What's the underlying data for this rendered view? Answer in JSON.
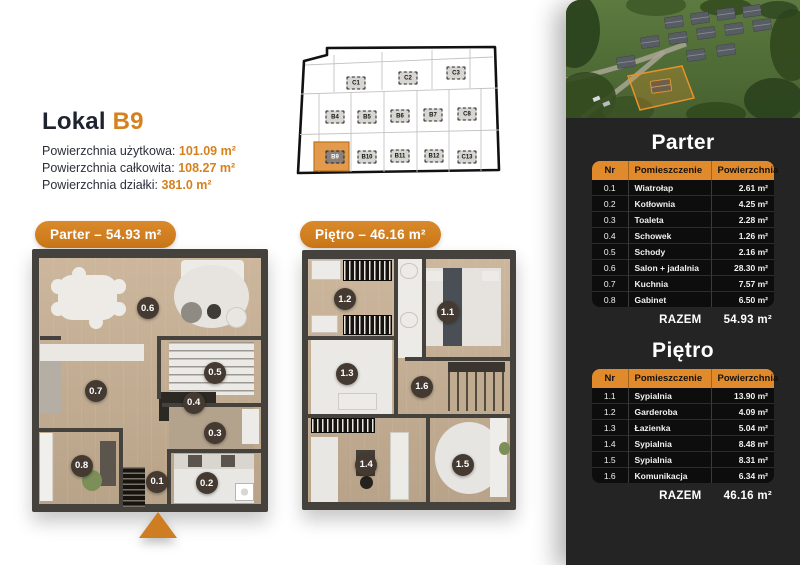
{
  "lokal": {
    "title_prefix": "Lokal",
    "unit": "B9",
    "specs": [
      {
        "label": "Powierzchnia użytkowa:",
        "value": "101.09 m²"
      },
      {
        "label": "Powierzchnia całkowita:",
        "value": "108.27 m²"
      },
      {
        "label": "Powierzchnia działki:",
        "value": "381.0 m²"
      }
    ]
  },
  "site_map": {
    "highlighted": "B9",
    "units": [
      "C1",
      "C2",
      "C3",
      "B4",
      "B5",
      "B6",
      "B7",
      "C8",
      "B9",
      "B10",
      "B11",
      "B12",
      "C13"
    ]
  },
  "plans": {
    "parter": {
      "badge": "Parter – 54.93 m²",
      "room_numbers": [
        "0.1",
        "0.2",
        "0.3",
        "0.4",
        "0.5",
        "0.6",
        "0.7",
        "0.8"
      ]
    },
    "pietro": {
      "badge": "Piętro – 46.16 m²",
      "room_numbers": [
        "1.1",
        "1.2",
        "1.3",
        "1.4",
        "1.5",
        "1.6"
      ]
    }
  },
  "panel": {
    "parter": {
      "title": "Parter",
      "columns": [
        "Nr",
        "Pomieszczenie",
        "Powierzchnia"
      ],
      "rows": [
        [
          "0.1",
          "Wiatrołap",
          "2.61 m²"
        ],
        [
          "0.2",
          "Kotłownia",
          "4.25 m²"
        ],
        [
          "0.3",
          "Toaleta",
          "2.28 m²"
        ],
        [
          "0.4",
          "Schowek",
          "1.26 m²"
        ],
        [
          "0.5",
          "Schody",
          "2.16 m²"
        ],
        [
          "0.6",
          "Salon + jadalnia",
          "28.30 m²"
        ],
        [
          "0.7",
          "Kuchnia",
          "7.57 m²"
        ],
        [
          "0.8",
          "Gabinet",
          "6.50 m²"
        ]
      ],
      "total_label": "RAZEM",
      "total_value": "54.93 m²"
    },
    "pietro": {
      "title": "Piętro",
      "columns": [
        "Nr",
        "Pomieszczenie",
        "Powierzchnia"
      ],
      "rows": [
        [
          "1.1",
          "Sypialnia",
          "13.90 m²"
        ],
        [
          "1.2",
          "Garderoba",
          "4.09 m²"
        ],
        [
          "1.3",
          "Łazienka",
          "5.04 m²"
        ],
        [
          "1.4",
          "Sypialnia",
          "8.48 m²"
        ],
        [
          "1.5",
          "Sypialnia",
          "8.31 m²"
        ],
        [
          "1.6",
          "Komunikacja",
          "6.34 m²"
        ]
      ],
      "total_label": "RAZEM",
      "total_value": "46.16 m²"
    }
  },
  "colors": {
    "accent": "#D5811E",
    "table_header": "#E08A2B",
    "panel_bg": "#242424",
    "row_bg": "#0D0D0D"
  }
}
